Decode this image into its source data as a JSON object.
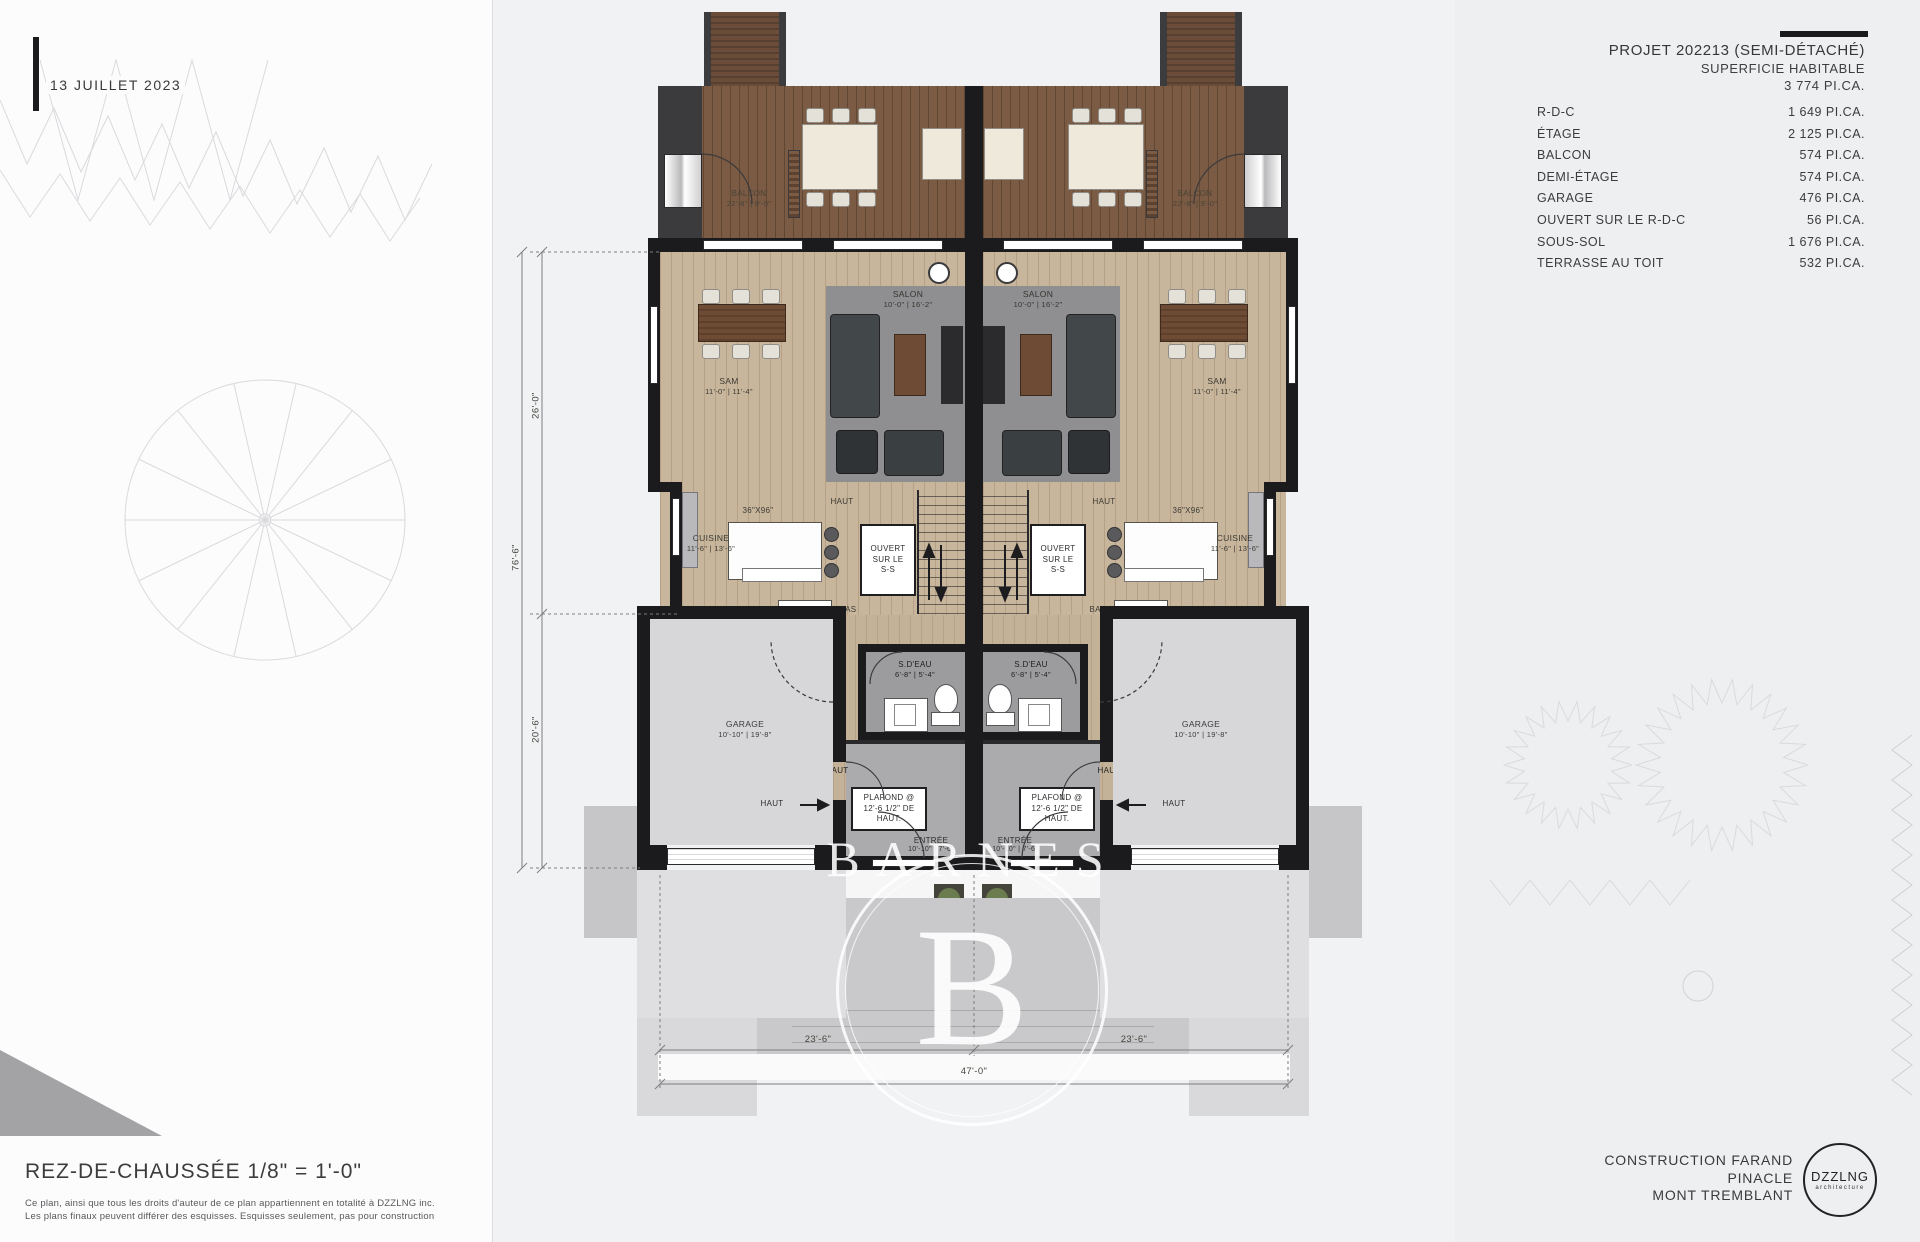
{
  "date": "13 JUILLET 2023",
  "project": {
    "title": "PROJET 202213 (SEMI-DÉTACHÉ)",
    "subtitle": "SUPERFICIE HABITABLE",
    "total": "3 774 PI.CA.",
    "rows": [
      {
        "label": "R-D-C",
        "value": "1 649 PI.CA."
      },
      {
        "label": "ÉTAGE",
        "value": "2 125 PI.CA."
      },
      {
        "label": "BALCON",
        "value": "574 PI.CA."
      },
      {
        "label": "DEMI-ÉTAGE",
        "value": "574 PI.CA."
      },
      {
        "label": "GARAGE",
        "value": "476 PI.CA."
      },
      {
        "label": "OUVERT SUR LE R-D-C",
        "value": "56 PI.CA."
      },
      {
        "label": "SOUS-SOL",
        "value": "1 676 PI.CA."
      },
      {
        "label": "TERRASSE AU TOIT",
        "value": "532 PI.CA."
      }
    ]
  },
  "plan": {
    "balcon": "BALCON",
    "balcon_dim": "22'-8\" | 9'-0\"",
    "salon": "SALON",
    "salon_dim": "10'-0\" | 16'-2\"",
    "sam": "SAM",
    "sam_dim": "11'-0\" | 11'-4\"",
    "cuisine": "CUISINE",
    "cuisine_dim": "11'-6\" | 13'-6\"",
    "island_dim": "36\"X96\"",
    "ouvert_line1": "OUVERT",
    "ouvert_line2": "SUR LE",
    "ouvert_line3": "S-S",
    "haut": "HAUT",
    "bas": "BAS",
    "bar": "BAR",
    "sdeau": "S.D'EAU",
    "sdeau_dim": "6'-8\" | 5'-4\"",
    "plafond_line1": "PLAFOND @",
    "plafond_line2": "12'-6 1/2\" DE",
    "plafond_line3": "HAUT.",
    "entree": "ENTRÉE",
    "entree_dim": "10'-10\" | 7'-6\"",
    "garage": "GARAGE",
    "garage_dim": "10'-10\" | 19'-8\""
  },
  "dims": {
    "left_upper": "26'-0\"",
    "left_full": "76'-6\"",
    "left_lower": "20'-6\"",
    "bottom_left": "23'-6\"",
    "bottom_right": "23'-6\"",
    "bottom_total": "47'-0\""
  },
  "footer_left": {
    "title": "REZ-DE-CHAUSSÉE  1/8\" = 1'-0\"",
    "disclaimer_1": "Ce plan, ainsi que tous les droits d'auteur de ce plan appartiennent en totalité à DZZLNG inc.",
    "disclaimer_2": "Les plans finaux peuvent différer des esquisses. Esquisses seulement, pas pour construction"
  },
  "footer_right": {
    "line1": "CONSTRUCTION FARAND",
    "line2": "PINACLE",
    "line3": "MONT TREMBLANT",
    "logo": "DZZLNG",
    "logo_sub": "architecture"
  },
  "watermark": {
    "text": "BARNES",
    "letter": "B"
  }
}
